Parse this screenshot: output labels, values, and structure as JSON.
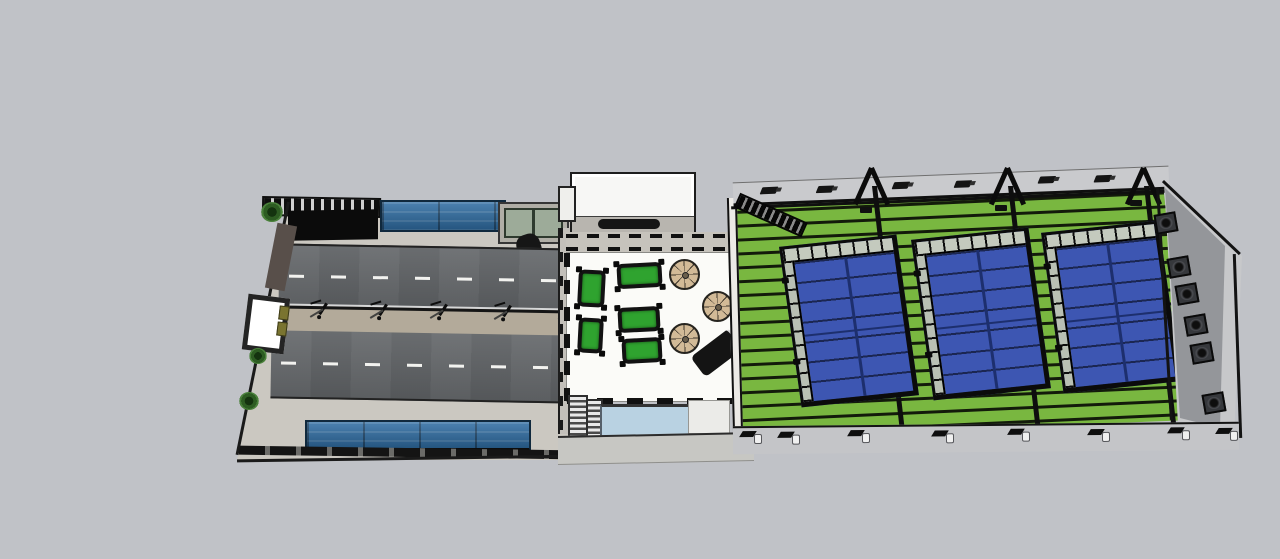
{
  "scene": {
    "description": "Top-down 3D architectural model of a sports club site: divided street with median and canopies, rooftop terrace with pool tables, parasols and plunge pool, and a steel-framed hall containing three padel courts on a green floor with an end wall of exhaust fans",
    "colors": {
      "background": "#c0c2c7",
      "pavement": "#cbc8c1",
      "road": "#5e6164",
      "median": "#b3aa9a",
      "lane_marking": "#f2f2ef",
      "canopy_blue": "#2f6da3",
      "terrace_floor": "#fbfbf8",
      "building_white": "#f7f7f5",
      "pool_table_green": "#2fa32f",
      "umbrella_tan": "#d2ba97",
      "pool_water": "#b9d2e2",
      "hall_floor_green": "#79b740",
      "court_blue": "#3d56b2",
      "court_line_blue": "#1d2f6e",
      "end_wall_gray": "#94969a",
      "glass_green": "#9dab99"
    },
    "street": {
      "street_light_count": 5,
      "vehicles": [
        "white-van",
        "dark-car",
        "white-car"
      ],
      "plant_count": 3,
      "billboard_count": 1,
      "canopy_count": 2,
      "lane_count": 2
    },
    "terrace": {
      "pool_table_count": 5,
      "umbrella_count": 3,
      "sofa_count": 1,
      "stair_flight_count": 2,
      "has_pool": true,
      "has_sign_band": true
    },
    "hall": {
      "court_count": 3,
      "roof_beam_count": 18,
      "truss_count": 3,
      "brace_count": 3,
      "top_light_count": 6,
      "fan_count": 6,
      "footing_count": 8
    }
  }
}
